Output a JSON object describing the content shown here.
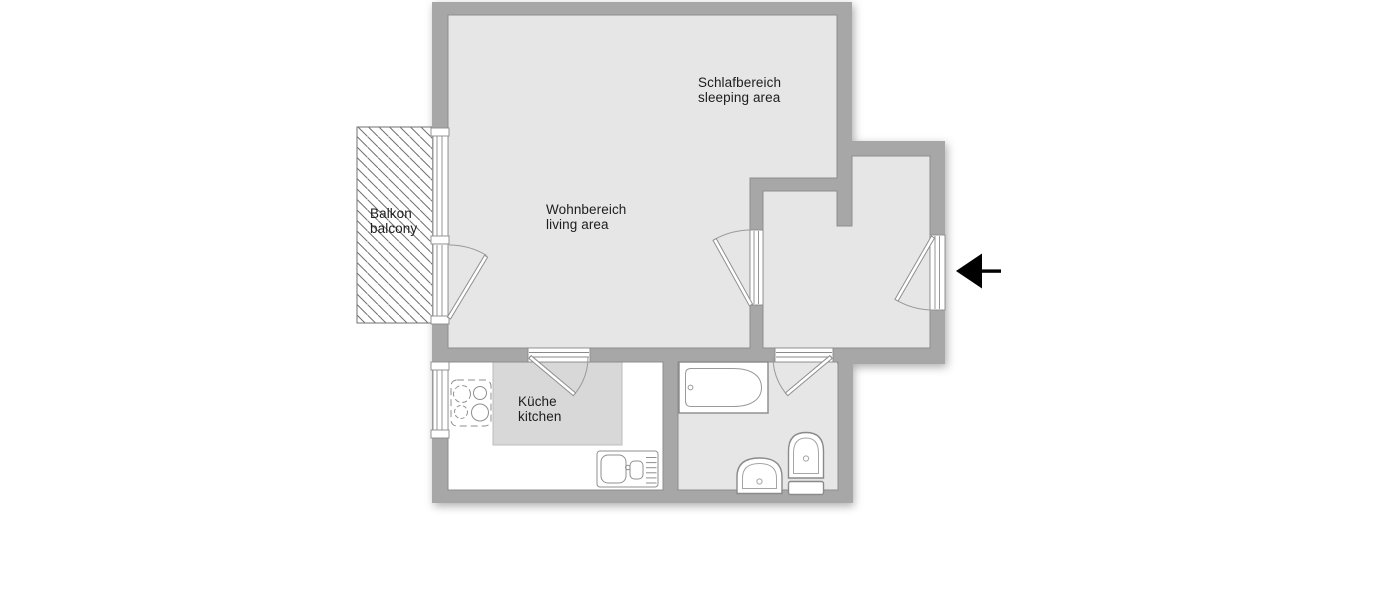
{
  "plan": {
    "rooms": [
      {
        "name": "sleeping-area",
        "label_de": "Schlafbereich",
        "label_en": "sleeping area"
      },
      {
        "name": "living-area",
        "label_de": "Wohnbereich",
        "label_en": "living area"
      },
      {
        "name": "balcony",
        "label_de": "Balkon",
        "label_en": "balcony"
      },
      {
        "name": "kitchen",
        "label_de": "Küche",
        "label_en": "kitchen"
      }
    ],
    "fixtures": [
      "stove",
      "kitchen-sink",
      "bathtub",
      "washbasin",
      "toilet"
    ],
    "symbols": [
      "window",
      "door-swing",
      "balcony-hatch",
      "entrance-arrow"
    ],
    "entrance": {
      "direction": "left"
    },
    "colors": {
      "wall": "#a7a7a7",
      "floor": "#e6e6e6",
      "kitchen_floor": "#d8d8d8",
      "outline": "#8d8d8d",
      "fixture_line": "#8f8f8f",
      "hatch": "#6f6f6f",
      "arrow": "#000000",
      "text": "#1d1d1d",
      "background": "#ffffff"
    }
  }
}
